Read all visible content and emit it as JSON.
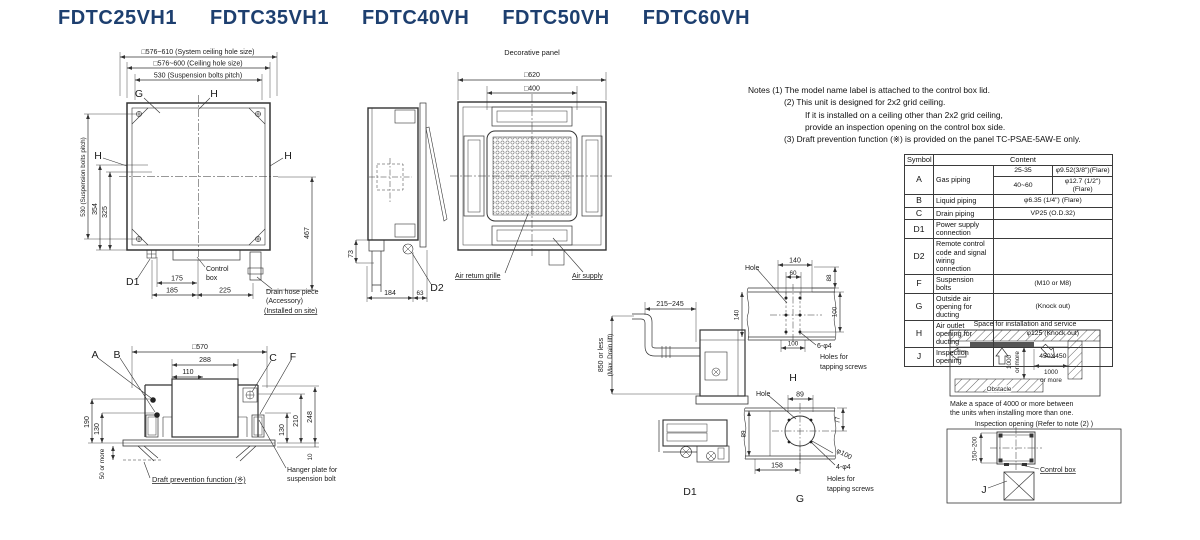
{
  "colors": {
    "title_text": "#1d3f6f",
    "line": "#333333",
    "background": "#ffffff"
  },
  "title": {
    "m1": "FDTC25VH1",
    "m2": "FDTC35VH1",
    "m3": "FDTC40VH",
    "m4": "FDTC50VH",
    "m5": "FDTC60VH"
  },
  "plan": {
    "dim_system": "□576~610 (System ceiling hole size)",
    "dim_ceiling": "□576~600 (Ceiling hole size)",
    "dim_pitch": "530 (Suspension bolts pitch)",
    "dim_pitch_v": "530 (Suspension bolts pitch)",
    "g": "G",
    "h_top": "H",
    "h_left": "H",
    "h_right": "H",
    "d354": "354",
    "d325": "325",
    "d467": "467",
    "d1": "D1",
    "d175": "175",
    "d185": "185",
    "d225": "225",
    "control_box_1": "Control",
    "control_box_2": "box",
    "drain_1": "Drain hose piece",
    "drain_2": "(Accessory)",
    "drain_3": "(Installed on site)"
  },
  "side": {
    "d73": "73",
    "d184": "184",
    "d63": "63",
    "d2": "D2"
  },
  "panel": {
    "title": "Decorative panel",
    "d620": "□620",
    "d400": "□400",
    "air_return": "Air return grille",
    "air_supply": "Air supply"
  },
  "notes": {
    "l1": "Notes (1) The model name label is attached to the control box lid.",
    "l2": "(2) This unit is designed for 2x2 grid ceiling.",
    "l3": "If it is installed on a ceiling other than 2x2 grid ceiling,",
    "l4": "provide an inspection opening on the control box side.",
    "l5": "(3) Draft prevention function (※) is provided on the panel TC-PSAE-5AW-E only."
  },
  "table": {
    "h_symbol": "Symbol",
    "h_content": "Content",
    "a_sym": "A",
    "a_desc": "Gas piping",
    "a_r1": "25-35",
    "a_v1": "φ9.52(3/8\")(Flare)",
    "a_r2": "40~60",
    "a_v2": "φ12.7 (1/2\") (Flare)",
    "b_sym": "B",
    "b_desc": "Liquid piping",
    "b_val": "φ6.35 (1/4\") (Flare)",
    "c_sym": "C",
    "c_desc": "Drain piping",
    "c_val": "VP25 (O.D.32)",
    "d1_sym": "D1",
    "d1_desc": "Power supply connection",
    "d1_val": "",
    "d2_sym": "D2",
    "d2_desc": "Remote control code and signal wiring connection",
    "d2_val": "",
    "f_sym": "F",
    "f_desc": "Suspension bolts",
    "f_val": "(M10 or M8)",
    "g_sym": "G",
    "g_desc": "Outside air opening for ducting",
    "g_val": "(Knock out)",
    "h_sym": "H",
    "h_desc": "Air outlet opening for ducting",
    "h_val": "φ125 (Knock out)",
    "j_sym": "J",
    "j_desc": "Inspection opening",
    "j_val": "450X450"
  },
  "section": {
    "d570": "□570",
    "d288": "288",
    "d110": "110",
    "a": "A",
    "b": "B",
    "c": "C",
    "f": "F",
    "d190": "190",
    "d130l": "130",
    "d50": "50 or more",
    "d248": "248",
    "d210": "210",
    "d130r": "130",
    "d10": "10",
    "draft": "Draft prevention function (※)",
    "hanger_1": "Hanger plate for",
    "hanger_2": "suspension bolt"
  },
  "drain": {
    "d215": "215~245",
    "d850": "850 or less",
    "d850b": "(Max. Drain lift)",
    "d1": "D1"
  },
  "holeH": {
    "hole": "Hole",
    "d140t": "140",
    "d60": "60",
    "d88": "88",
    "d140l": "140",
    "d100r": "100",
    "d100b": "100",
    "screws1": "6-φ4",
    "screws2": "Holes for",
    "screws3": "tapping screws",
    "label": "H"
  },
  "holeG": {
    "hole": "Hole",
    "d89t": "89",
    "d89l": "89",
    "d77": "77",
    "d100": "φ100",
    "d158": "158",
    "screws1": "4-φ4",
    "screws2": "Holes for",
    "screws3": "tapping screws",
    "label": "G"
  },
  "space": {
    "title": "Space for installation and service",
    "v1": "1000",
    "v2": "or more",
    "r1": "1000",
    "r2": "or more",
    "obstacle": "Obstacle",
    "cap1": "Make a space of 4000 or more between",
    "cap2": "the units when installing more than one."
  },
  "inspection": {
    "title": "Inspection opening (Refer to note (2) )",
    "d150": "150~200",
    "control_box": "Control box",
    "j": "J"
  }
}
